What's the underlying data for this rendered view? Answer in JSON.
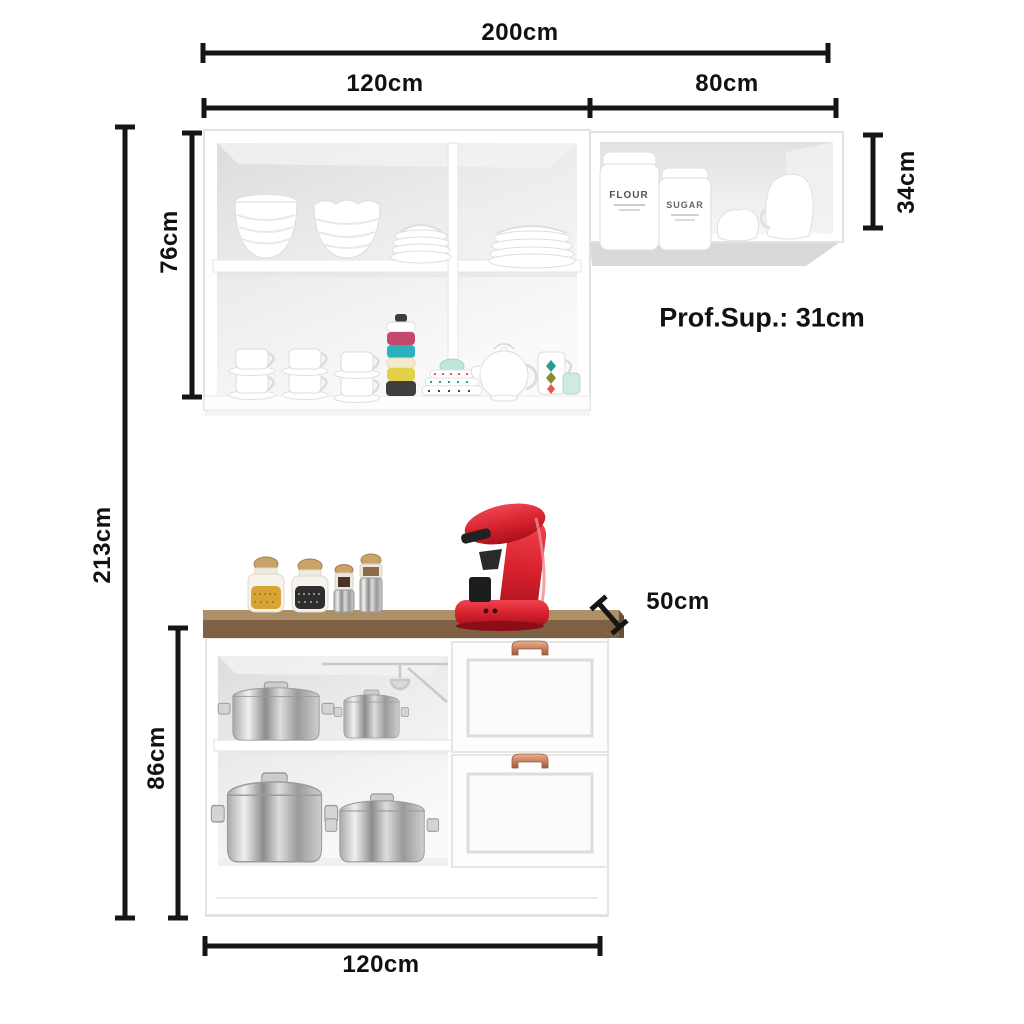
{
  "dimensions": {
    "overall_width": "200cm",
    "wall_left_section_width": "120cm",
    "wall_right_section_width": "80cm",
    "wall_left_cabinet_height": "76cm",
    "wall_right_cabinet_height": "34cm",
    "overall_height": "213cm",
    "base_cabinet_height": "86cm",
    "base_cabinet_width": "120cm",
    "countertop_depth": "50cm",
    "wall_depth_note": "Prof.Sup.: 31cm"
  },
  "canister_labels": {
    "flour": "FLOUR",
    "sugar": "SUGAR"
  },
  "colors": {
    "dimension_line": "#151515",
    "label_text": "#111111",
    "cabinet_white": "#ffffff",
    "interior_gray": "#e9e9e9",
    "countertop_front": "#7e6043",
    "countertop_top": "#ad8f68",
    "handle_copper": "#c07a55",
    "coffee_machine_red": "#d8232f",
    "pot_steel": "#b9b9b9",
    "accent_teal": "#29b2bd",
    "accent_pink": "#c4486b",
    "accent_yellow": "#e3d14c"
  }
}
